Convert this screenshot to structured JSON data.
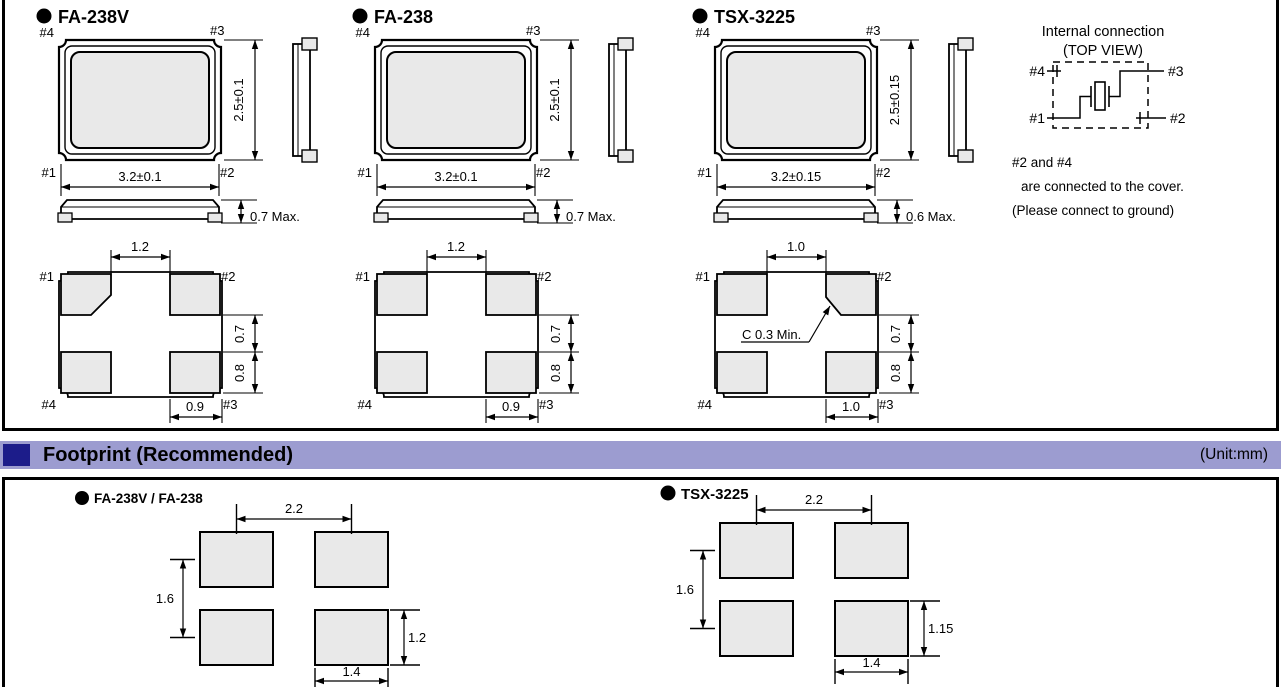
{
  "packages": [
    {
      "name": "FA-238V",
      "top_view": {
        "pin_tl": "#4",
        "pin_tr": "#3",
        "pin_bl": "#1",
        "pin_br": "#2",
        "width_dim": "3.2±0.1",
        "height_dim": "2.5±0.1"
      },
      "profile": {
        "height_dim": "0.7 Max."
      },
      "pad_view": {
        "pin_tl": "#1",
        "pin_tr": "#2",
        "pin_bl": "#4",
        "pin_br": "#3",
        "top_dim": "1.2",
        "right_upper_dim": "0.7",
        "right_lower_dim": "0.8",
        "bottom_dim": "0.9",
        "chamfer_corner": "tl",
        "chamfer_note": ""
      }
    },
    {
      "name": "FA-238",
      "top_view": {
        "pin_tl": "#4",
        "pin_tr": "#3",
        "pin_bl": "#1",
        "pin_br": "#2",
        "width_dim": "3.2±0.1",
        "height_dim": "2.5±0.1"
      },
      "profile": {
        "height_dim": "0.7 Max."
      },
      "pad_view": {
        "pin_tl": "#1",
        "pin_tr": "#2",
        "pin_bl": "#4",
        "pin_br": "#3",
        "top_dim": "1.2",
        "right_upper_dim": "0.7",
        "right_lower_dim": "0.8",
        "bottom_dim": "0.9",
        "chamfer_corner": "",
        "chamfer_note": ""
      }
    },
    {
      "name": "TSX-3225",
      "top_view": {
        "pin_tl": "#4",
        "pin_tr": "#3",
        "pin_bl": "#1",
        "pin_br": "#2",
        "width_dim": "3.2±0.15",
        "height_dim": "2.5±0.15"
      },
      "profile": {
        "height_dim": "0.6 Max."
      },
      "pad_view": {
        "pin_tl": "#1",
        "pin_tr": "#2",
        "pin_bl": "#4",
        "pin_br": "#3",
        "top_dim": "1.0",
        "right_upper_dim": "0.7",
        "right_lower_dim": "0.8",
        "bottom_dim": "1.0",
        "chamfer_corner": "tr",
        "chamfer_note": "C 0.3 Min."
      }
    }
  ],
  "internal_connection": {
    "title_line1": "Internal connection",
    "title_line2": "(TOP VIEW)",
    "pin_tl": "#4",
    "pin_tr": "#3",
    "pin_bl": "#1",
    "pin_br": "#2",
    "note_line1": "#2 and #4",
    "note_line2": "are connected to the cover.",
    "note_line3": "(Please connect to ground)"
  },
  "footprint_section": {
    "title": "Footprint (Recommended)",
    "unit": "(Unit:mm)"
  },
  "footprints": [
    {
      "name": "FA-238V / FA-238",
      "horizontal_dim": "2.2",
      "vertical_dim": "1.6",
      "pad_height_dim": "1.2",
      "pad_width_dim": "1.4"
    },
    {
      "name": "TSX-3225",
      "horizontal_dim": "2.2",
      "vertical_dim": "1.6",
      "pad_height_dim": "1.15",
      "pad_width_dim": "1.4"
    }
  ],
  "colors": {
    "section_bar_bg": "#9c9cd0",
    "section_bullet": "#1c1c8a",
    "pad_fill": "#e9e9e9",
    "line": "#000000"
  }
}
